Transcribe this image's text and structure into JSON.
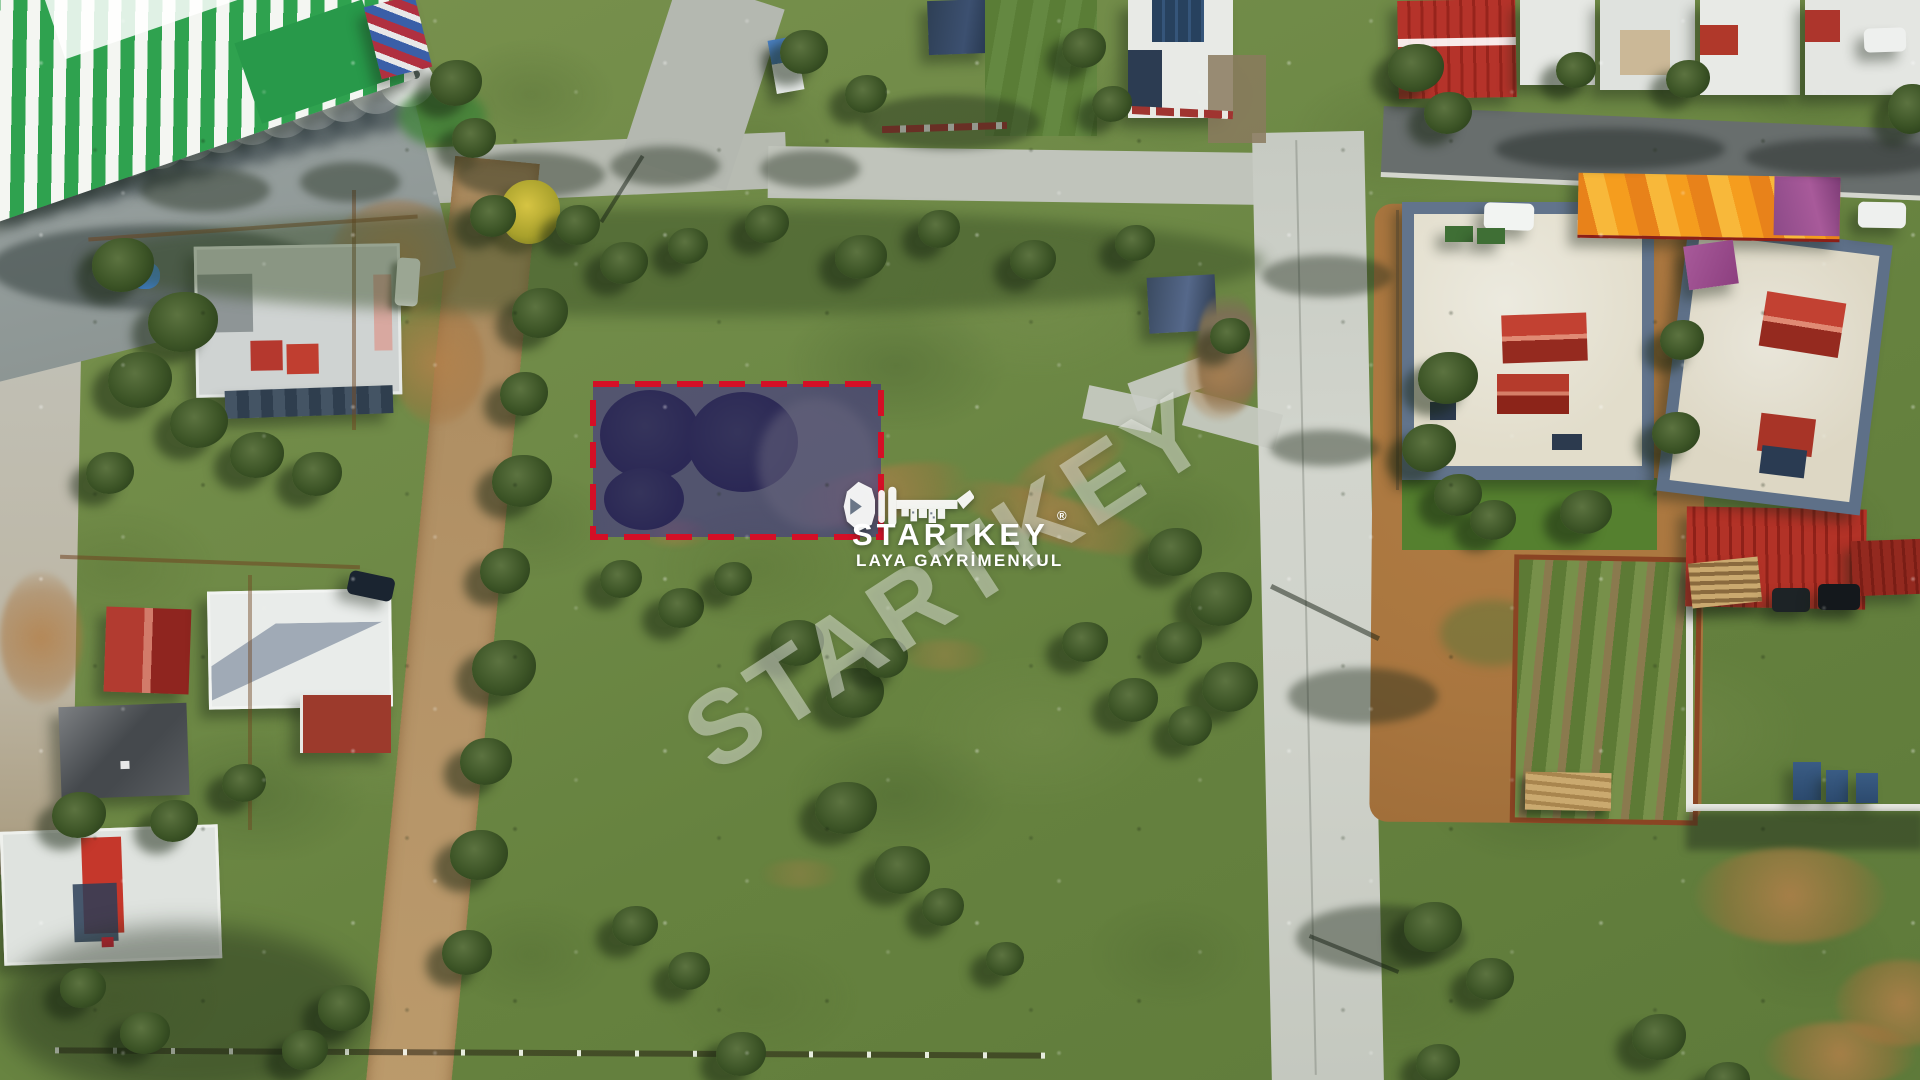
{
  "watermark": {
    "diagonal_text": "STARTKEY",
    "color": "#f2f4ee",
    "opacity": "0.46"
  },
  "logo": {
    "brand": "STARTKEY",
    "registered_mark": "®",
    "subtitle": "LAYA GAYRİMENKUL",
    "icon": "key-with-city-skyline",
    "color": "#ffffff"
  },
  "plot_marker": {
    "border_color": "#d40f26",
    "border_style": "dashed",
    "fill_color": "rgba(56,32,152,0.5)"
  }
}
